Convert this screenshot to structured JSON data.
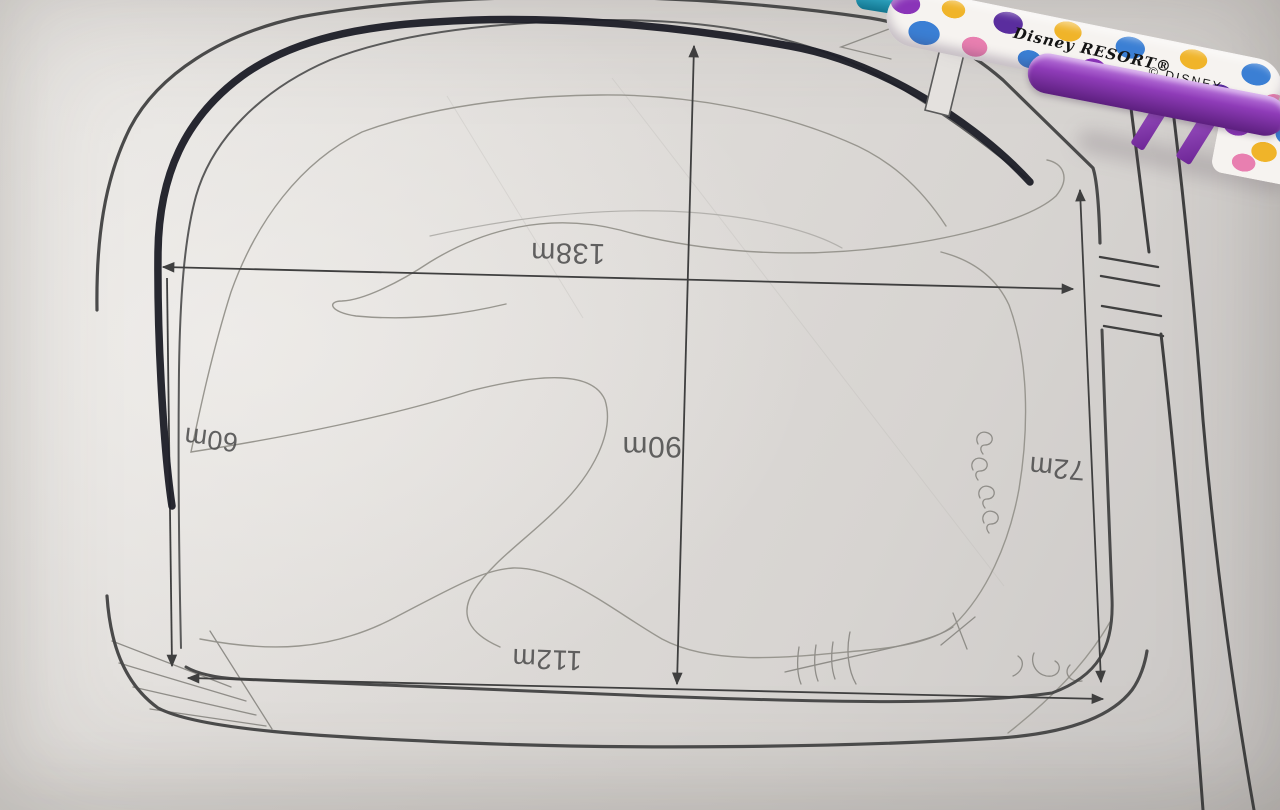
{
  "diagram": {
    "labels": {
      "top_width": "138m",
      "center_height": "90m",
      "left_height": "60m",
      "right_height": "72m",
      "bottom_width": "112m"
    },
    "handwritten_marks": "9 9 9 9",
    "colors": {
      "paper": "#dedbd8",
      "boundary_ink": "#4a4a4a",
      "marker_ink": "#1e1f29",
      "pencil": "#98968f",
      "dimension_ink": "#3f3f3f"
    }
  },
  "pens": {
    "floral_pen_brand": "Disney RESORT®",
    "floral_pen_copyright": "© DISNEY",
    "colors": {
      "pen_purple": "#7b2fa0",
      "pen_teal": "#2a9cb8",
      "floral_blue": "#3b7fd4",
      "floral_yellow": "#f0b429",
      "floral_pink": "#e87fb0"
    }
  }
}
